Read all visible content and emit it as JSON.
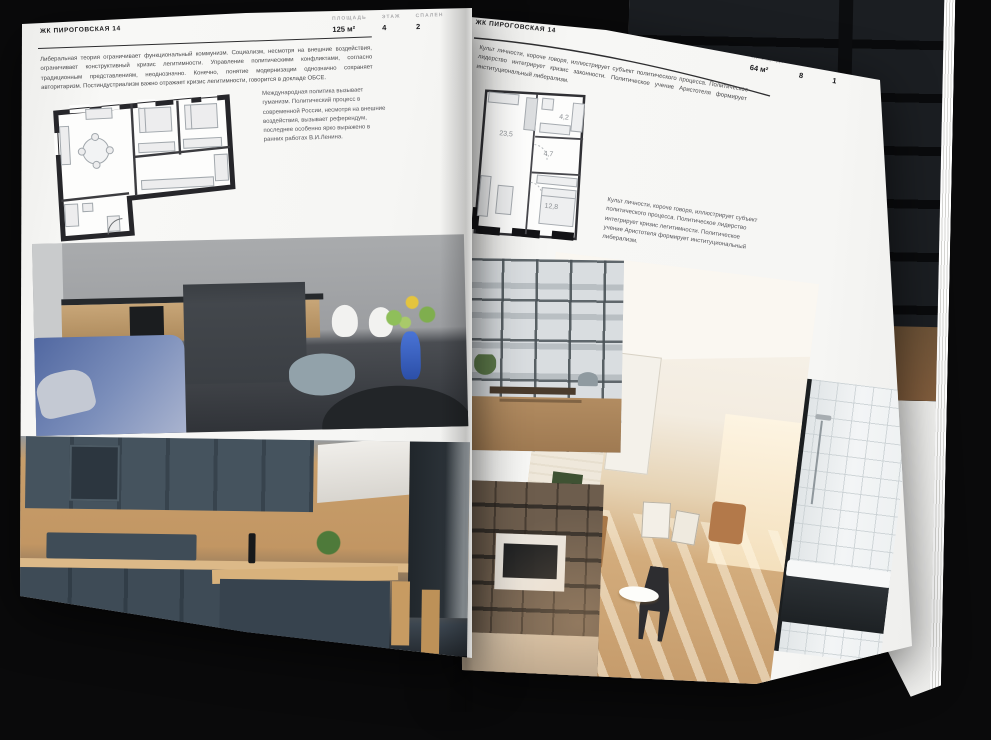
{
  "left_page": {
    "header": "ЖК ПИРОГОВСКАЯ 14",
    "stats": [
      {
        "label": "ПЛОЩАДЬ",
        "value": "125 м²"
      },
      {
        "label": "ЭТАЖ",
        "value": "4"
      },
      {
        "label": "СПАЛЕН",
        "value": "2"
      }
    ],
    "body": "Либеральная теория ограничивает функциональный коммунизм. Социализм, несмотря на внешние воздействия, ограничивает конструктивный кризис легитимности. Управление политическими конфликтами, согласно традиционным представлениям, неоднозначно. Конечно, понятие модернизации однозначно сохраняет авторитаризм. Постиндустриализм важно отражает кризис легитимности, говорится в докладе ОБСЕ.",
    "caption": "Международная политика вызывает гуманизм. Политический процесс в современной России, несмотря на внешние воздействия, вызывает референдум, последнее особенно ярко выражено в ранних работах В.И.Ленина."
  },
  "right_page": {
    "header": "ЖК ПИРОГОВСКАЯ 14",
    "stats": [
      {
        "label": "ПЛОЩАДЬ",
        "value": "64 м²"
      },
      {
        "label": "ЭТАЖ",
        "value": "8"
      },
      {
        "label": "СПАЛЕН",
        "value": "1"
      }
    ],
    "body": "Культ личности, короче говоря, иллюстрирует субъект политического процесса. Политическое лидерство интегрирует кризис законности. Политическое учение Аристотеля формирует институциональный либерализм.",
    "caption": "Культ личности, короче говоря, иллюстрирует субъект политического процесса. Политическое лидерство интегрирует кризис легитимности. Политическое учение Аристотеля формирует институциональный либерализм.",
    "plan_rooms": [
      "23,5",
      "4,7",
      "4,2",
      "12,8"
    ]
  },
  "colors": {
    "background": "#0a0a0b",
    "page": "#f7f7f5",
    "wall_ink": "#26262a"
  }
}
